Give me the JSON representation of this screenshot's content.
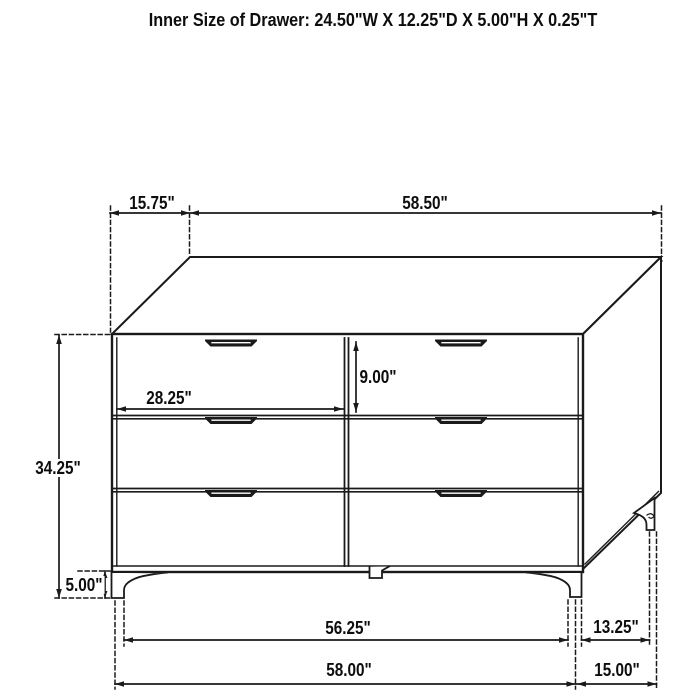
{
  "title": "Inner Size of Drawer: 24.50\"W X 12.25\"D X 5.00\"H X 0.25\"T",
  "colors": {
    "line": "#1a1a1a",
    "background": "#ffffff",
    "text": "#0d0d0d"
  },
  "diagram": {
    "type": "furniture-dimension-drawing",
    "object": "six-drawer-dresser",
    "drawer_count": 6,
    "dimensions": {
      "top_depth": "15.75\"",
      "top_width": "58.50\"",
      "drawer_front_width": "28.25\"",
      "drawer_front_height": "9.00\"",
      "body_height": "34.25\"",
      "leg_height": "5.00\"",
      "front_leg_span": "56.25\"",
      "side_leg_span": "13.25\"",
      "overall_width": "58.00\"",
      "overall_depth": "15.00\""
    }
  }
}
